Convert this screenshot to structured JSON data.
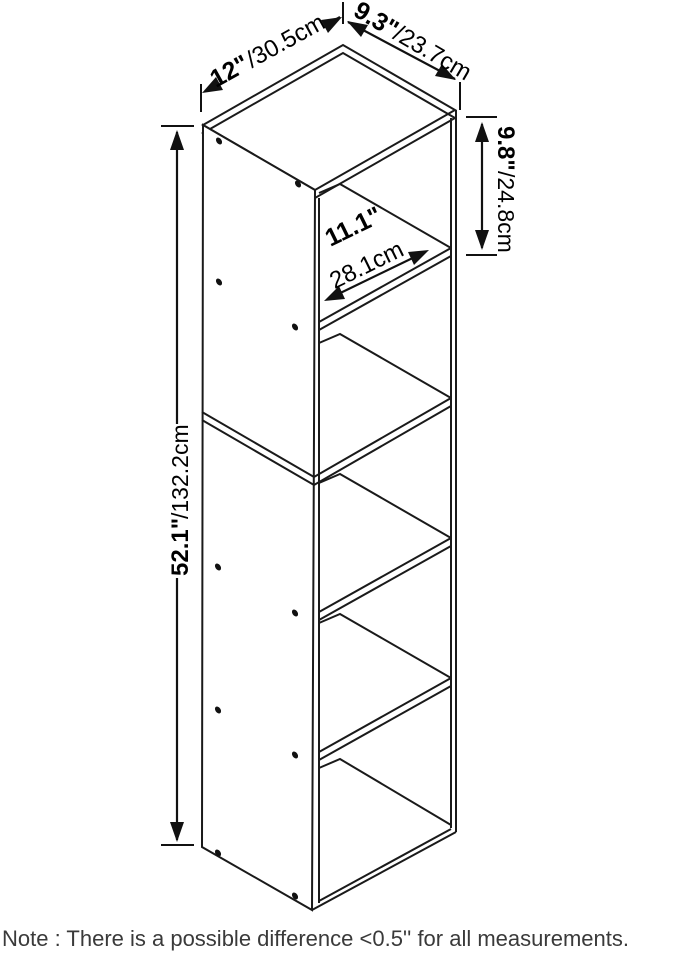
{
  "diagram": {
    "kind": "bookshelf-dimension-drawing",
    "colors": {
      "line": "#1a1a1a",
      "text": "#000000",
      "note": "#3a3a3a",
      "background": "#ffffff"
    },
    "dimensions": {
      "width": {
        "inches": "12\"",
        "cm": "/30.5cm"
      },
      "depth": {
        "inches": "9.3\"",
        "cm": "/23.7cm"
      },
      "compartment": {
        "inches": "9.8\"",
        "cm": "/24.8cm"
      },
      "interior": {
        "inches": "11.1\"",
        "cm": "28.1cm"
      },
      "height": {
        "inches": "52.1\"",
        "cm": "/132.2cm"
      }
    },
    "note": "Note : There is a possible difference <0.5'' for all measurements."
  }
}
